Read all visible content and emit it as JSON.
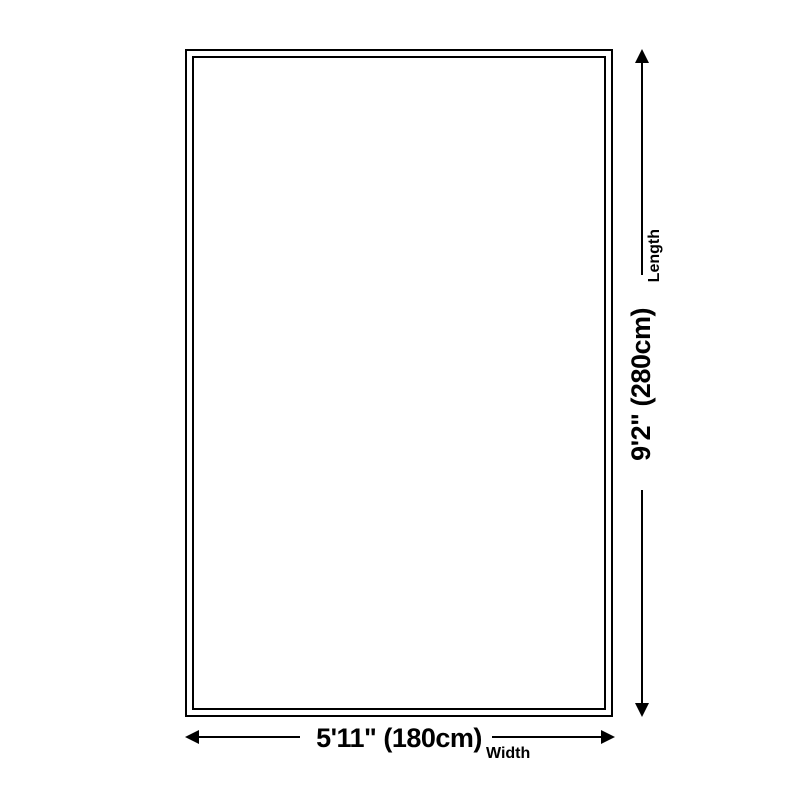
{
  "diagram": {
    "type": "rug-size-diagram",
    "background_color": "#ffffff",
    "line_color": "#000000",
    "length": {
      "value": "9'2\" (280cm)",
      "label": "Length"
    },
    "width": {
      "value": "5'11\" (180cm)",
      "label": "Width"
    }
  }
}
